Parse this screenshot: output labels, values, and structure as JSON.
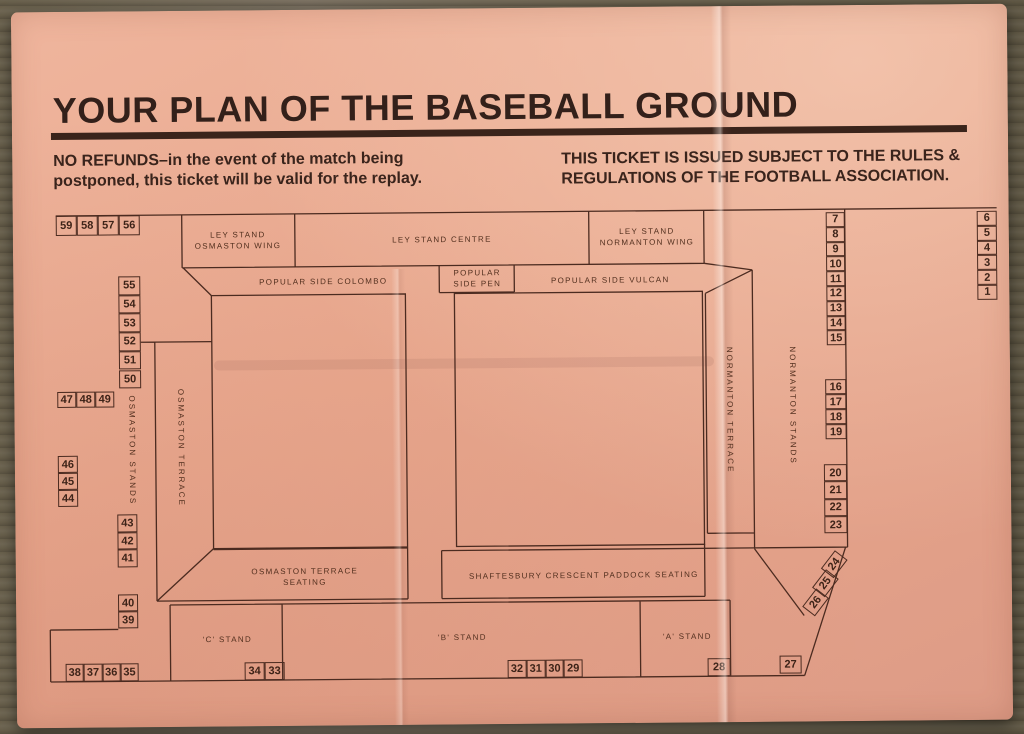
{
  "ticket": {
    "title": "YOUR PLAN OF THE BASEBALL GROUND",
    "refund_notice": "NO REFUNDS–in the event of the match being\npostponed, this ticket will be valid for the replay.",
    "rules_notice": "THIS TICKET IS ISSUED SUBJECT TO THE RULES &\nREGULATIONS OF THE FOOTBALL ASSOCIATION.",
    "colors": {
      "ticket_pink": "#e9a88e",
      "ink": "#3a241c",
      "wood": "#6e644f"
    }
  },
  "plan": {
    "stands": {
      "ley_osmaston": "LEY STAND\nOSMASTON WING",
      "ley_centre": "LEY STAND CENTRE",
      "ley_normanton": "LEY STAND\nNORMANTON WING",
      "colombo": "POPULAR SIDE  COLOMBO",
      "pen": "POPULAR\nSIDE PEN",
      "vulcan": "POPULAR SIDE  VULCAN",
      "osmaston_terrace_seating": "OSMASTON TERRACE\nSEATING",
      "shaftesbury": "SHAFTESBURY CRESCENT PADDOCK SEATING",
      "c_stand": "'C' STAND",
      "b_stand": "'B' STAND",
      "a_stand": "'A' STAND",
      "osmaston_stands": "OSMASTON STANDS",
      "osmaston_terrace": "OSMASTON TERRACE",
      "normanton_terrace": "NORMANTON TERRACE",
      "normanton_stands": "NORMANTON STANDS"
    },
    "blocks": {
      "top_left_row": [
        "59",
        "58",
        "57",
        "56"
      ],
      "left_upper_col": [
        "55",
        "54",
        "53",
        "52",
        "51",
        "50"
      ],
      "left_row_47_49": [
        "47",
        "48",
        "49"
      ],
      "left_mid_col": [
        "46",
        "45",
        "44"
      ],
      "left_col_43_41": [
        "43",
        "42",
        "41"
      ],
      "left_col_40_39": [
        "40",
        "39"
      ],
      "bottom_left_row": [
        "38",
        "37",
        "36",
        "35"
      ],
      "bottom_c_row": [
        "34",
        "33"
      ],
      "bottom_b_row": [
        "32",
        "31",
        "30",
        "29"
      ],
      "box_28": [
        "28"
      ],
      "box_27": [
        "27"
      ],
      "right_col_7_15": [
        "7",
        "8",
        "9",
        "10",
        "11",
        "12",
        "13",
        "14",
        "15"
      ],
      "far_right_col": [
        "6",
        "5",
        "4",
        "3",
        "2",
        "1"
      ],
      "right_col_16_19": [
        "16",
        "17",
        "18",
        "19"
      ],
      "right_col_20_23": [
        "20",
        "21",
        "22",
        "23"
      ],
      "diag_col_24_26": [
        "24",
        "25",
        "26"
      ]
    }
  }
}
